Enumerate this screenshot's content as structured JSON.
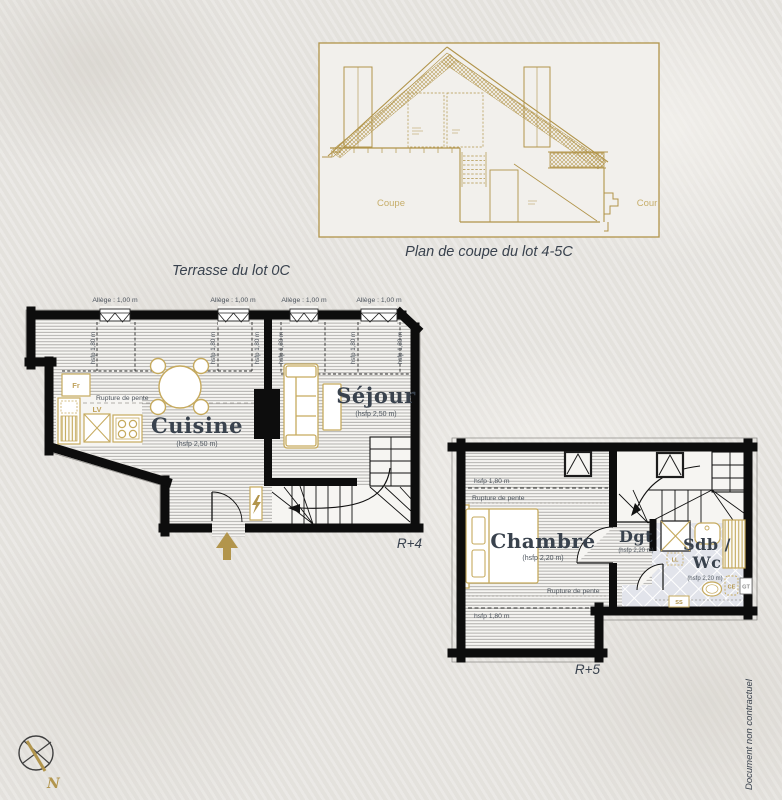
{
  "meta": {
    "side_note": "Document non contractuel",
    "north_label": "N"
  },
  "colors": {
    "gold": "#b2954c",
    "ink": "#39424e",
    "wall": "#0d0d0d"
  },
  "coupe": {
    "caption": "Plan de coupe du lot 4-5C",
    "label_left": "Coupe",
    "label_right": "Cour"
  },
  "r4": {
    "terrace_title": "Terrasse du lot 0C",
    "level_label": "R+4",
    "allege": "Allège : 1,00 m",
    "hsfp_line": "hsfp 1,80 m",
    "rupture": "Rupture de pente",
    "kitchen": {
      "name": "Cuisine",
      "height": "(hsfp 2,50 m)",
      "fridge": "Fr",
      "dishwasher": "LV"
    },
    "living": {
      "name": "Séjour",
      "height": "(hsfp 2,50 m)"
    }
  },
  "r5": {
    "level_label": "R+5",
    "hsfp_line": "hsfp 1,80 m",
    "rupture": "Rupture de pente",
    "bedroom": {
      "name": "Chambre",
      "height": "(hsfp 2,20 m)"
    },
    "hallway": {
      "name": "Dgt",
      "height": "(hsfp 2,20 m)"
    },
    "bathroom": {
      "name_line1": "Sdb /",
      "name_line2": "Wc",
      "height": "(hsfp 2,20 m)",
      "washer": "LL",
      "water_heater": "CE",
      "duct": "GT",
      "towel_rail": "SS"
    }
  }
}
